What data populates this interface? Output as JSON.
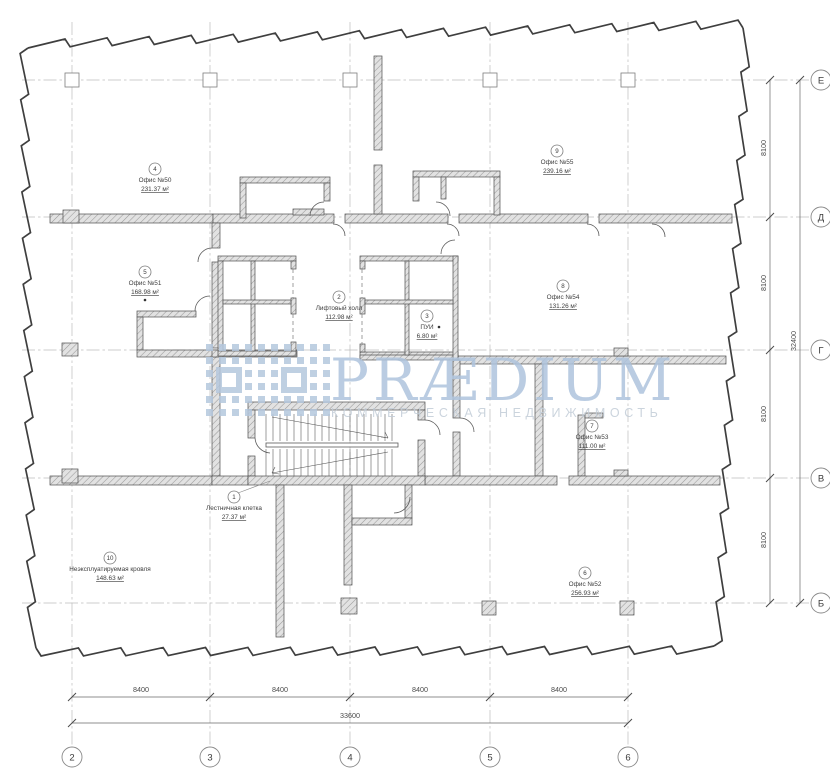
{
  "watermark": {
    "brand": "PRÆDIUM",
    "tagline": "КОММЕРЧЕСКАЯ НЕДВИЖИМОСТЬ",
    "brand_color": "#afc4dd",
    "tagline_color": "#c3cdd8",
    "logo_color": "#b5c8de"
  },
  "grid": {
    "column_bubbles": [
      "2",
      "3",
      "4",
      "5",
      "6"
    ],
    "row_bubbles": [
      "Е",
      "Д",
      "Г",
      "В",
      "Б"
    ]
  },
  "dimensions": {
    "bottom_segments": [
      "8400",
      "8400",
      "8400",
      "8400"
    ],
    "bottom_total": "33600",
    "right_segments": [
      "8100",
      "8100",
      "8100",
      "8100"
    ],
    "right_total": "32400"
  },
  "rooms": [
    {
      "num": "1",
      "name": "Лестничная клетка",
      "area": "27.37 м²"
    },
    {
      "num": "2",
      "name": "Лифтовый холл",
      "area": "112.98 м²"
    },
    {
      "num": "3",
      "name": "ПУИ",
      "area": "6.80 м²"
    },
    {
      "num": "4",
      "name": "Офис №50",
      "area": "231.37 м²"
    },
    {
      "num": "5",
      "name": "Офис №51",
      "area": "168.98 м²"
    },
    {
      "num": "6",
      "name": "Офис №52",
      "area": "256.93 м²"
    },
    {
      "num": "7",
      "name": "Офис №53",
      "area": "111.00 м²"
    },
    {
      "num": "8",
      "name": "Офис №54",
      "area": "131.26 м²"
    },
    {
      "num": "9",
      "name": "Офис №55",
      "area": "239.16 м²"
    },
    {
      "num": "10",
      "name": "Неэксплуатируемая кровля",
      "area": "148.63 м²"
    }
  ],
  "colors": {
    "drawing_line": "#3f3f3f",
    "grid_line": "#bcbcbc",
    "wall_fill": "#e2e2e2",
    "wall_hatch": "#9a9a9a",
    "dim_line": "#6a6a6a"
  }
}
